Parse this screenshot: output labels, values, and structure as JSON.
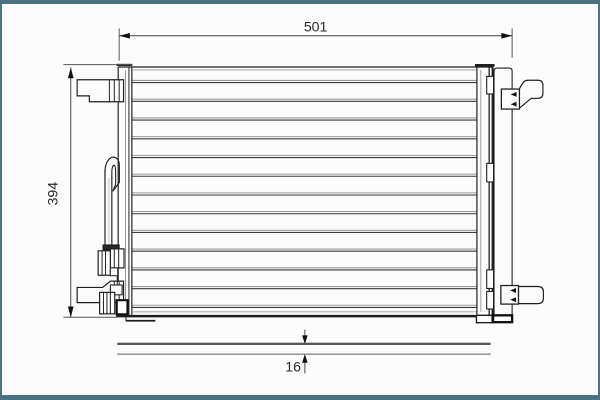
{
  "frame": {
    "border_color": "#4a7280",
    "background": "#fcfcfc"
  },
  "drawing": {
    "kind": "technical-line-drawing",
    "subject": "condenser with receiver drier, front view and side profile",
    "line_color": "#1e1e1e",
    "dimensions": {
      "width": {
        "label": "501",
        "location": "top",
        "orientation": "horizontal"
      },
      "height": {
        "label": "394",
        "location": "left",
        "orientation": "vertical"
      },
      "depth": {
        "label": "16",
        "location": "bottom",
        "orientation": "vertical"
      }
    },
    "core": {
      "tube_line_count": 13,
      "first_tube_y": 78.2,
      "tube_spacing": 19.1667,
      "x1": 128,
      "x2": 481,
      "tube_top_color": "#9a9a9a",
      "tube_bottom_color": "#3a3a3a"
    }
  }
}
